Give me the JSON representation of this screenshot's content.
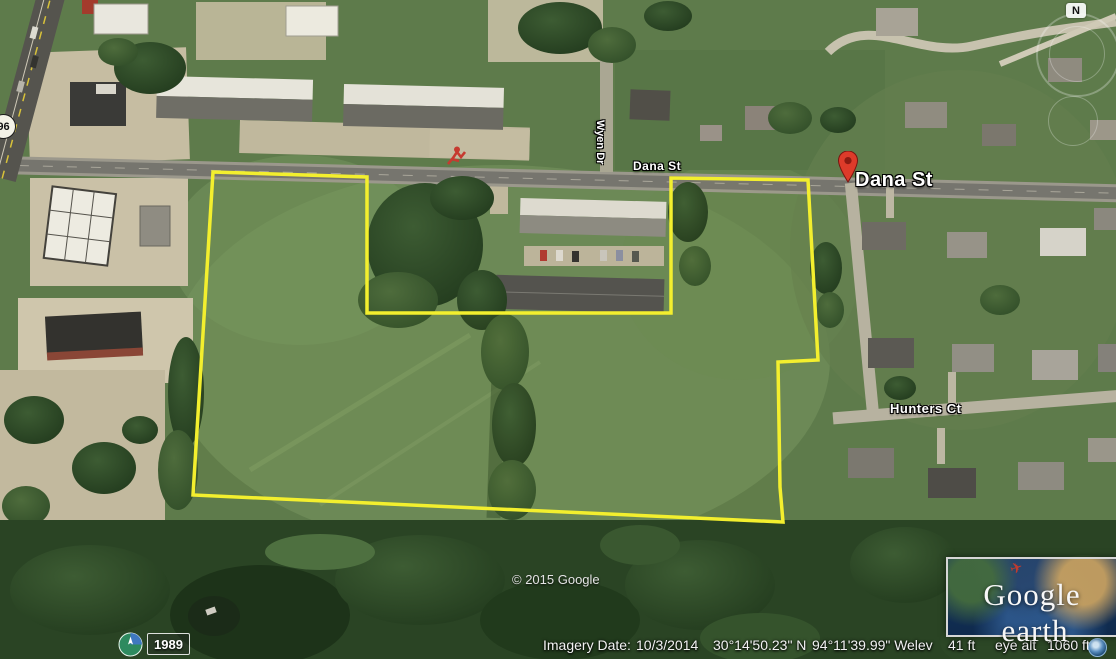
{
  "window": {
    "title": "Google Earth"
  },
  "colors": {
    "boundary": "#f3ef2e",
    "pin": "#dd3b2a",
    "pin_dark": "#8c1b12",
    "label_text": "#ffffff"
  },
  "map_labels": {
    "dana_st_small": "Dana St",
    "wyen_dr": "Wyen Dr",
    "hunters_ct": "Hunters Ct",
    "highway_shield": "96",
    "placemark_label": "Dana St",
    "copyright": "© 2015 Google"
  },
  "navigation": {
    "north_label": "N"
  },
  "time_control": {
    "year": "1989"
  },
  "status_bar": {
    "imagery_date_label": "Imagery Date:",
    "imagery_date": "10/3/2014",
    "latitude": "30°14'50.23\" N",
    "longitude": "94°11'39.99\" W",
    "elev_label": "elev",
    "elev_value": "41 ft",
    "eye_alt_label": "eye alt",
    "eye_alt_value": "1060 ft"
  },
  "logo": {
    "brand": "Google",
    "product": "earth"
  }
}
